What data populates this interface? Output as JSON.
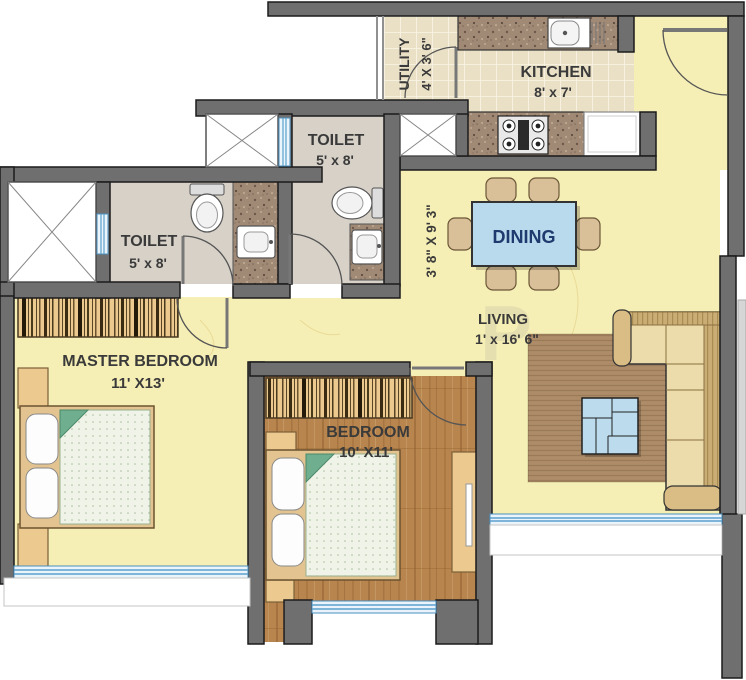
{
  "watermark": "P",
  "rooms": {
    "utility": {
      "name": "UTILITY",
      "dims": "4' X 3' 6\""
    },
    "kitchen": {
      "name": "KITCHEN",
      "dims": "8' x 7'"
    },
    "toilet_attached": {
      "name": "TOILET",
      "dims": "5' x 8'"
    },
    "toilet_common": {
      "name": "TOILET",
      "dims": "5' x 8'"
    },
    "dining": {
      "name": "DINING"
    },
    "passage": {
      "dims": "3' 8\" X 9' 3\""
    },
    "living": {
      "name": "LIVING",
      "dims": "1' x 16' 6\""
    },
    "master_bedroom": {
      "name": "MASTER BEDROOM",
      "dims": "11' X13'"
    },
    "bedroom": {
      "name": "BEDROOM",
      "dims": "10' X11'"
    }
  },
  "colors": {
    "wall": "#6f6f6f",
    "floor_yellow": "#f6efb5",
    "wood": "#b8854f",
    "tile": "#eae0c6",
    "toilet_floor": "#d7d1c8",
    "granite": "#a18a75",
    "furniture_tan": "#ecc98e",
    "sofa_cream": "#ecdcab",
    "rug_brown": "#ab8a66",
    "table_blue": "#b9d9ec",
    "window_blue": "#5aa0cc",
    "dining_text": "#1e3a6e",
    "label_text": "#3a3a3a"
  }
}
